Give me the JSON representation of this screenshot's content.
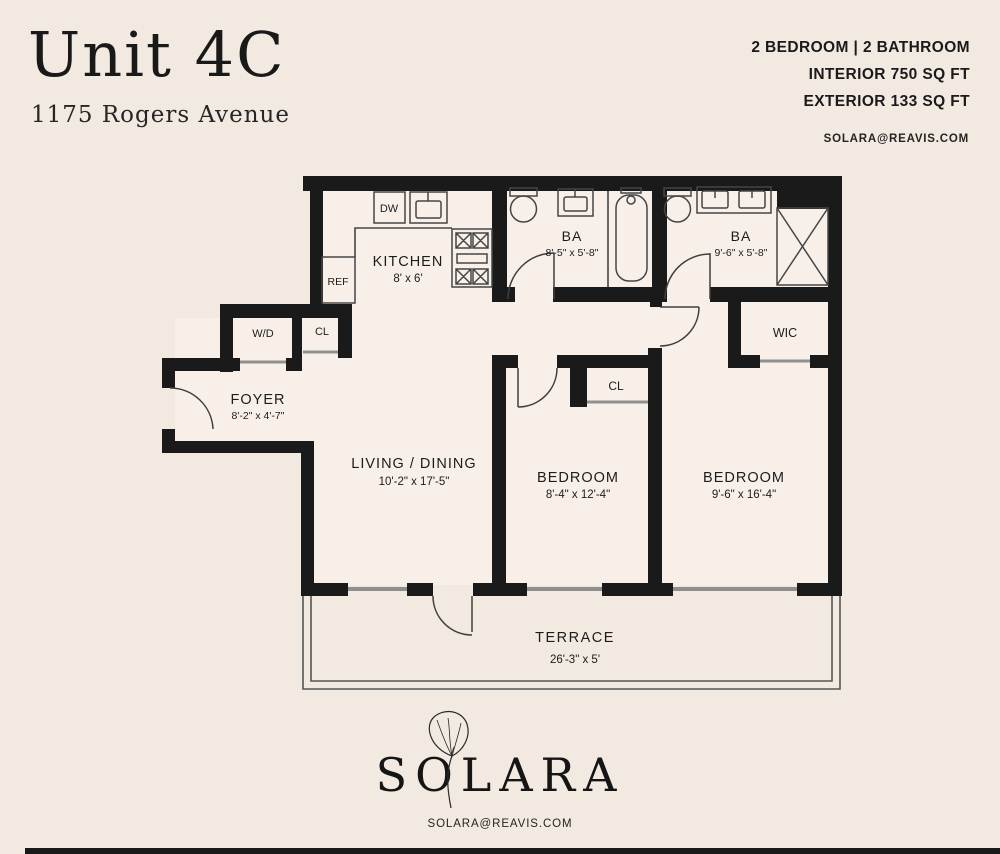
{
  "header": {
    "unit_title": "Unit 4C",
    "address": "1175 Rogers Avenue",
    "spec_line1": "2 BEDROOM | 2 BATHROOM",
    "spec_line2": "INTERIOR 750 SQ FT",
    "spec_line3": "EXTERIOR 133 SQ FT",
    "email": "SOLARA@REAVIS.COM"
  },
  "plan": {
    "kitchen": {
      "label": "KITCHEN",
      "dims": "8' x 6'"
    },
    "bath1": {
      "label": "BA",
      "dims": "8'-5\" x 5'-8\""
    },
    "bath2": {
      "label": "BA",
      "dims": "9'-6\" x 5'-8\""
    },
    "foyer": {
      "label": "FOYER",
      "dims": "8'-2\" x 4'-7\""
    },
    "living": {
      "label": "LIVING / DINING",
      "dims": "10'-2\" x 17'-5\""
    },
    "bedroom1": {
      "label": "BEDROOM",
      "dims": "8'-4\" x 12'-4\""
    },
    "bedroom2": {
      "label": "BEDROOM",
      "dims": "9'-6\" x 16'-4\""
    },
    "terrace": {
      "label": "TERRACE",
      "dims": "26'-3\" x 5'"
    },
    "washer_dryer": "W/D",
    "entry_closet": "CL",
    "bedroom_closet": "CL",
    "walk_in_closet": "WIC",
    "dishwasher": "DW",
    "refrigerator": "REF"
  },
  "footer": {
    "brand": "SOLARA",
    "email": "SOLARA@REAVIS.COM"
  },
  "colors": {
    "background": "#f2e9e1",
    "plan_interior": "#f8f0e8",
    "walls": "#1a1a1a",
    "thin_lines": "#454545",
    "window_lines": "#8f8f8f",
    "text": "#1c1c1c"
  }
}
